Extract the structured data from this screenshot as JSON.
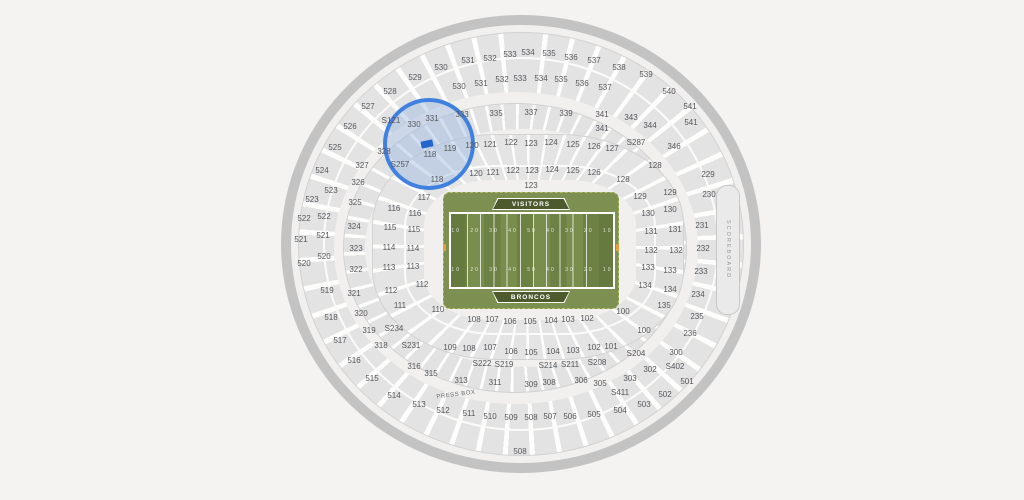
{
  "map": {
    "visitors_label": "VISITORS",
    "broncos_label": "BRONCOS",
    "press_box_label": "PRESS BOX",
    "scoreboard_label": "SCOREBOARD",
    "yard_numbers": "10 20 30 40 50 40 30 20 10",
    "colors": {
      "background": "#f4f3f1",
      "section_fill": "#e3e3e4",
      "field_green": "#7d9051",
      "field_stripe_dark": "#6e8144",
      "banner_green": "#4c5a2e",
      "highlight_blue": "#4080df",
      "marker_blue": "#2365cb"
    },
    "selection": {
      "sections_highlighted": [
        "S121",
        "330",
        "331",
        "328",
        "S257",
        "118",
        "119",
        "120"
      ],
      "highlight": {
        "cx": 429,
        "cy": 144,
        "rx": 46,
        "ry": 46
      },
      "marker": {
        "x": 427,
        "y": 144
      }
    },
    "sections": [
      {
        "label": "525",
        "x": 335,
        "y": 148
      },
      {
        "label": "526",
        "x": 350,
        "y": 127
      },
      {
        "label": "527",
        "x": 368,
        "y": 107
      },
      {
        "label": "528",
        "x": 390,
        "y": 92
      },
      {
        "label": "529",
        "x": 415,
        "y": 78
      },
      {
        "label": "530",
        "x": 441,
        "y": 68
      },
      {
        "label": "531",
        "x": 468,
        "y": 61
      },
      {
        "label": "532",
        "x": 490,
        "y": 59
      },
      {
        "label": "533",
        "x": 510,
        "y": 55
      },
      {
        "label": "534",
        "x": 528,
        "y": 53
      },
      {
        "label": "535",
        "x": 549,
        "y": 54
      },
      {
        "label": "536",
        "x": 571,
        "y": 58
      },
      {
        "label": "537",
        "x": 594,
        "y": 61
      },
      {
        "label": "538",
        "x": 619,
        "y": 68
      },
      {
        "label": "539",
        "x": 646,
        "y": 75
      },
      {
        "label": "540",
        "x": 669,
        "y": 92
      },
      {
        "label": "541",
        "x": 690,
        "y": 107
      },
      {
        "label": "541",
        "x": 691,
        "y": 123
      },
      {
        "label": "530",
        "x": 459,
        "y": 87
      },
      {
        "label": "531",
        "x": 481,
        "y": 84
      },
      {
        "label": "532",
        "x": 502,
        "y": 80
      },
      {
        "label": "533",
        "x": 520,
        "y": 79
      },
      {
        "label": "534",
        "x": 541,
        "y": 79
      },
      {
        "label": "535",
        "x": 561,
        "y": 80
      },
      {
        "label": "536",
        "x": 582,
        "y": 84
      },
      {
        "label": "537",
        "x": 605,
        "y": 88
      },
      {
        "label": "524",
        "x": 322,
        "y": 171
      },
      {
        "label": "523",
        "x": 312,
        "y": 200
      },
      {
        "label": "523",
        "x": 331,
        "y": 191
      },
      {
        "label": "522",
        "x": 304,
        "y": 219
      },
      {
        "label": "522",
        "x": 324,
        "y": 217
      },
      {
        "label": "521",
        "x": 301,
        "y": 240
      },
      {
        "label": "521",
        "x": 323,
        "y": 236
      },
      {
        "label": "520",
        "x": 304,
        "y": 264
      },
      {
        "label": "520",
        "x": 324,
        "y": 257
      },
      {
        "label": "519",
        "x": 327,
        "y": 291
      },
      {
        "label": "518",
        "x": 331,
        "y": 318
      },
      {
        "label": "517",
        "x": 340,
        "y": 341
      },
      {
        "label": "516",
        "x": 354,
        "y": 361
      },
      {
        "label": "515",
        "x": 372,
        "y": 379
      },
      {
        "label": "514",
        "x": 394,
        "y": 396
      },
      {
        "label": "513",
        "x": 419,
        "y": 405
      },
      {
        "label": "512",
        "x": 443,
        "y": 411
      },
      {
        "label": "511",
        "x": 469,
        "y": 414
      },
      {
        "label": "510",
        "x": 490,
        "y": 417
      },
      {
        "label": "509",
        "x": 511,
        "y": 418
      },
      {
        "label": "508",
        "x": 531,
        "y": 418
      },
      {
        "label": "507",
        "x": 550,
        "y": 417
      },
      {
        "label": "506",
        "x": 570,
        "y": 417
      },
      {
        "label": "505",
        "x": 594,
        "y": 415
      },
      {
        "label": "504",
        "x": 620,
        "y": 411
      },
      {
        "label": "503",
        "x": 644,
        "y": 405
      },
      {
        "label": "502",
        "x": 665,
        "y": 395
      },
      {
        "label": "501",
        "x": 687,
        "y": 382
      },
      {
        "label": "508",
        "x": 520,
        "y": 452
      },
      {
        "label": "S121",
        "x": 391,
        "y": 121
      },
      {
        "label": "S257",
        "x": 400,
        "y": 165
      },
      {
        "label": "S287",
        "x": 636,
        "y": 143
      },
      {
        "label": "S234",
        "x": 394,
        "y": 329
      },
      {
        "label": "S231",
        "x": 411,
        "y": 346
      },
      {
        "label": "S222",
        "x": 482,
        "y": 364
      },
      {
        "label": "S219",
        "x": 504,
        "y": 365
      },
      {
        "label": "S214",
        "x": 548,
        "y": 366
      },
      {
        "label": "S211",
        "x": 570,
        "y": 365
      },
      {
        "label": "S208",
        "x": 597,
        "y": 363
      },
      {
        "label": "S204",
        "x": 636,
        "y": 354
      },
      {
        "label": "S402",
        "x": 675,
        "y": 367
      },
      {
        "label": "S411",
        "x": 620,
        "y": 393
      },
      {
        "label": "331",
        "x": 432,
        "y": 119
      },
      {
        "label": "330",
        "x": 414,
        "y": 125
      },
      {
        "label": "328",
        "x": 384,
        "y": 152
      },
      {
        "label": "333",
        "x": 462,
        "y": 115
      },
      {
        "label": "335",
        "x": 496,
        "y": 114
      },
      {
        "label": "337",
        "x": 531,
        "y": 113
      },
      {
        "label": "339",
        "x": 566,
        "y": 114
      },
      {
        "label": "341",
        "x": 602,
        "y": 115
      },
      {
        "label": "341",
        "x": 602,
        "y": 129
      },
      {
        "label": "343",
        "x": 631,
        "y": 118
      },
      {
        "label": "344",
        "x": 650,
        "y": 126
      },
      {
        "label": "346",
        "x": 674,
        "y": 147
      },
      {
        "label": "327",
        "x": 362,
        "y": 166
      },
      {
        "label": "326",
        "x": 358,
        "y": 183
      },
      {
        "label": "325",
        "x": 355,
        "y": 203
      },
      {
        "label": "324",
        "x": 354,
        "y": 227
      },
      {
        "label": "323",
        "x": 356,
        "y": 249
      },
      {
        "label": "322",
        "x": 356,
        "y": 270
      },
      {
        "label": "321",
        "x": 354,
        "y": 294
      },
      {
        "label": "320",
        "x": 361,
        "y": 314
      },
      {
        "label": "319",
        "x": 369,
        "y": 331
      },
      {
        "label": "318",
        "x": 381,
        "y": 346
      },
      {
        "label": "316",
        "x": 414,
        "y": 367
      },
      {
        "label": "315",
        "x": 431,
        "y": 374
      },
      {
        "label": "313",
        "x": 461,
        "y": 381
      },
      {
        "label": "311",
        "x": 495,
        "y": 383
      },
      {
        "label": "309",
        "x": 531,
        "y": 385
      },
      {
        "label": "308",
        "x": 549,
        "y": 383
      },
      {
        "label": "306",
        "x": 581,
        "y": 381
      },
      {
        "label": "305",
        "x": 600,
        "y": 384
      },
      {
        "label": "303",
        "x": 630,
        "y": 379
      },
      {
        "label": "302",
        "x": 650,
        "y": 370
      },
      {
        "label": "300",
        "x": 676,
        "y": 353
      },
      {
        "label": "118",
        "x": 430,
        "y": 155
      },
      {
        "label": "119",
        "x": 450,
        "y": 149
      },
      {
        "label": "120",
        "x": 472,
        "y": 146
      },
      {
        "label": "121",
        "x": 490,
        "y": 145
      },
      {
        "label": "122",
        "x": 511,
        "y": 143
      },
      {
        "label": "123",
        "x": 531,
        "y": 144
      },
      {
        "label": "124",
        "x": 551,
        "y": 143
      },
      {
        "label": "125",
        "x": 573,
        "y": 145
      },
      {
        "label": "126",
        "x": 594,
        "y": 147
      },
      {
        "label": "127",
        "x": 612,
        "y": 149
      },
      {
        "label": "118",
        "x": 437,
        "y": 180
      },
      {
        "label": "120",
        "x": 476,
        "y": 174
      },
      {
        "label": "121",
        "x": 493,
        "y": 173
      },
      {
        "label": "122",
        "x": 513,
        "y": 171
      },
      {
        "label": "123",
        "x": 532,
        "y": 171
      },
      {
        "label": "124",
        "x": 552,
        "y": 170
      },
      {
        "label": "125",
        "x": 573,
        "y": 171
      },
      {
        "label": "126",
        "x": 594,
        "y": 173
      },
      {
        "label": "123",
        "x": 531,
        "y": 186
      },
      {
        "label": "117",
        "x": 424,
        "y": 198
      },
      {
        "label": "116",
        "x": 394,
        "y": 209
      },
      {
        "label": "116",
        "x": 415,
        "y": 214
      },
      {
        "label": "115",
        "x": 390,
        "y": 228
      },
      {
        "label": "115",
        "x": 414,
        "y": 230
      },
      {
        "label": "114",
        "x": 389,
        "y": 248
      },
      {
        "label": "114",
        "x": 413,
        "y": 249
      },
      {
        "label": "113",
        "x": 389,
        "y": 268
      },
      {
        "label": "113",
        "x": 413,
        "y": 267
      },
      {
        "label": "112",
        "x": 391,
        "y": 291
      },
      {
        "label": "112",
        "x": 422,
        "y": 285
      },
      {
        "label": "111",
        "x": 400,
        "y": 306
      },
      {
        "label": "110",
        "x": 438,
        "y": 310
      },
      {
        "label": "108",
        "x": 474,
        "y": 320
      },
      {
        "label": "107",
        "x": 492,
        "y": 320
      },
      {
        "label": "106",
        "x": 510,
        "y": 322
      },
      {
        "label": "105",
        "x": 530,
        "y": 322
      },
      {
        "label": "104",
        "x": 551,
        "y": 321
      },
      {
        "label": "103",
        "x": 568,
        "y": 320
      },
      {
        "label": "102",
        "x": 587,
        "y": 319
      },
      {
        "label": "100",
        "x": 623,
        "y": 312
      },
      {
        "label": "109",
        "x": 450,
        "y": 348
      },
      {
        "label": "108",
        "x": 469,
        "y": 349
      },
      {
        "label": "107",
        "x": 490,
        "y": 348
      },
      {
        "label": "106",
        "x": 511,
        "y": 352
      },
      {
        "label": "105",
        "x": 531,
        "y": 353
      },
      {
        "label": "104",
        "x": 553,
        "y": 352
      },
      {
        "label": "103",
        "x": 573,
        "y": 351
      },
      {
        "label": "102",
        "x": 594,
        "y": 348
      },
      {
        "label": "101",
        "x": 611,
        "y": 347
      },
      {
        "label": "100",
        "x": 644,
        "y": 331
      },
      {
        "label": "128",
        "x": 623,
        "y": 180
      },
      {
        "label": "128",
        "x": 655,
        "y": 166
      },
      {
        "label": "129",
        "x": 640,
        "y": 197
      },
      {
        "label": "129",
        "x": 670,
        "y": 193
      },
      {
        "label": "130",
        "x": 648,
        "y": 214
      },
      {
        "label": "130",
        "x": 670,
        "y": 210
      },
      {
        "label": "131",
        "x": 651,
        "y": 232
      },
      {
        "label": "131",
        "x": 675,
        "y": 230
      },
      {
        "label": "132",
        "x": 651,
        "y": 251
      },
      {
        "label": "132",
        "x": 676,
        "y": 251
      },
      {
        "label": "133",
        "x": 648,
        "y": 268
      },
      {
        "label": "133",
        "x": 670,
        "y": 271
      },
      {
        "label": "134",
        "x": 645,
        "y": 286
      },
      {
        "label": "134",
        "x": 670,
        "y": 290
      },
      {
        "label": "135",
        "x": 664,
        "y": 306
      },
      {
        "label": "229",
        "x": 708,
        "y": 175
      },
      {
        "label": "230",
        "x": 709,
        "y": 195
      },
      {
        "label": "231",
        "x": 702,
        "y": 226
      },
      {
        "label": "232",
        "x": 703,
        "y": 249
      },
      {
        "label": "233",
        "x": 701,
        "y": 272
      },
      {
        "label": "234",
        "x": 698,
        "y": 295
      },
      {
        "label": "235",
        "x": 697,
        "y": 317
      },
      {
        "label": "236",
        "x": 690,
        "y": 334
      }
    ]
  }
}
